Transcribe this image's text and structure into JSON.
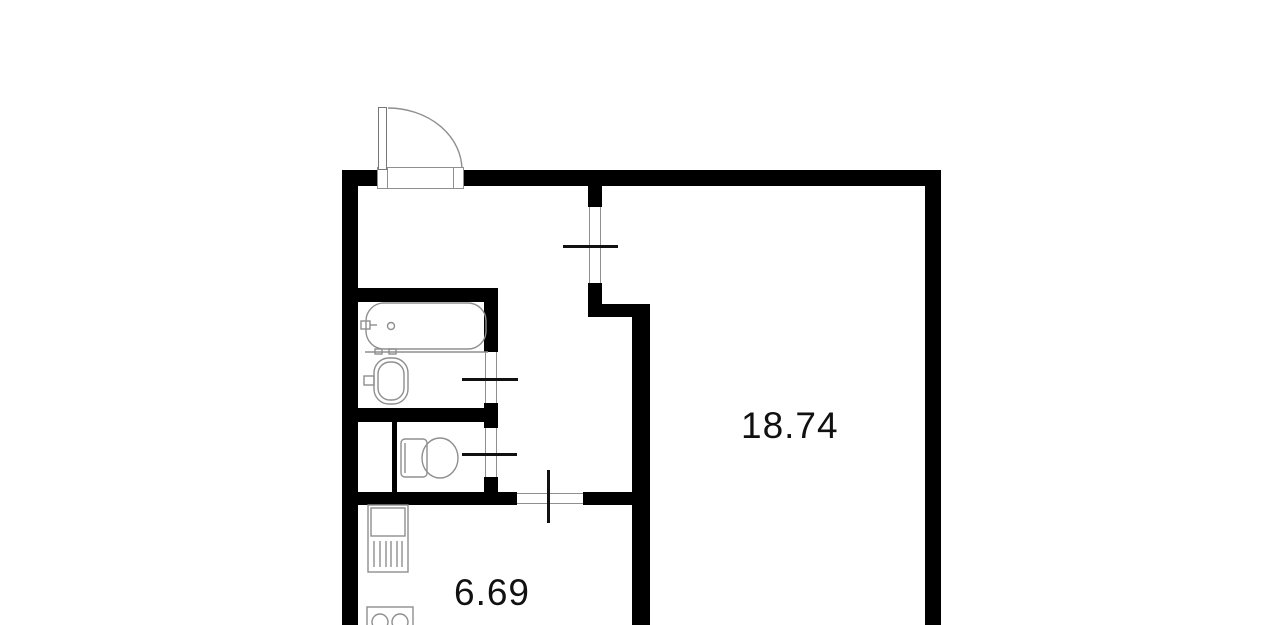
{
  "colors": {
    "wall": "#000000",
    "background": "#ffffff",
    "fixture_line": "#8f8f8f",
    "door_line": "#111111",
    "label_text": "#111111"
  },
  "rooms": {
    "living": {
      "area": "18.74"
    },
    "kitchen": {
      "area": "6.69"
    }
  },
  "fixtures": [
    "bathtub",
    "washbasin",
    "toilet",
    "kitchen-sink",
    "stove",
    "entry-door"
  ]
}
